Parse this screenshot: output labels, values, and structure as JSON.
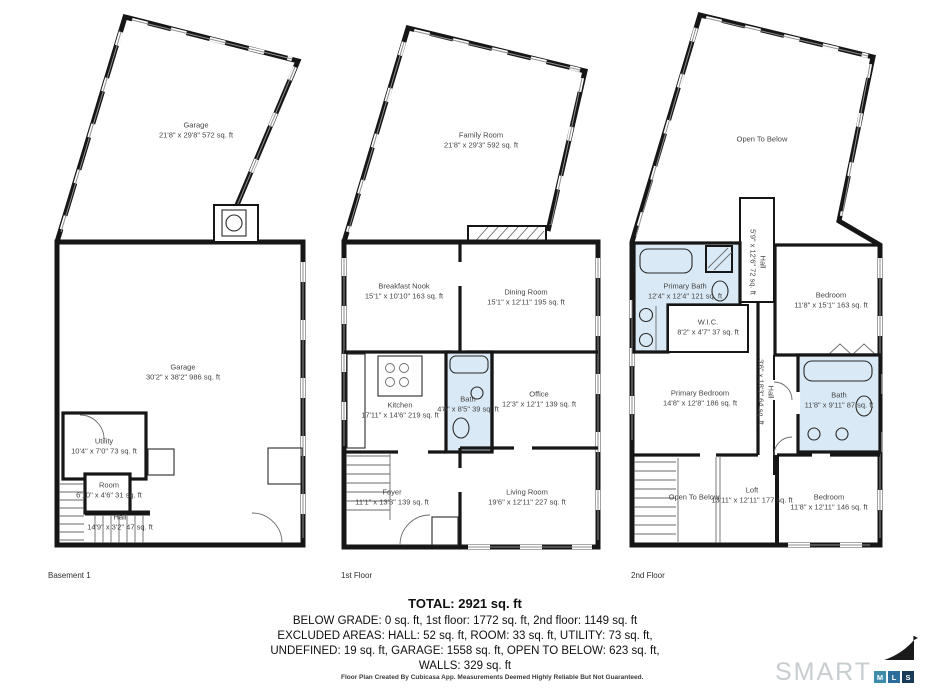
{
  "floors": [
    {
      "caption": "Basement 1",
      "rooms": [
        {
          "name": "Garage",
          "dims": "21'8\" x 29'8\" 572 sq. ft"
        },
        {
          "name": "Garage",
          "dims": "30'2\" x 38'2\" 986 sq. ft"
        },
        {
          "name": "Utility",
          "dims": "10'4\" x 7'0\" 73 sq. ft"
        },
        {
          "name": "Room",
          "dims": "6'10\" x 4'6\" 31 sq. ft"
        },
        {
          "name": "Hall",
          "dims": "14'9\" x 3'2\" 47 sq. ft"
        }
      ]
    },
    {
      "caption": "1st Floor",
      "rooms": [
        {
          "name": "Family Room",
          "dims": "21'8\" x 29'3\" 592 sq. ft"
        },
        {
          "name": "Breakfast Nook",
          "dims": "15'1\" x 10'10\" 163 sq. ft"
        },
        {
          "name": "Dining Room",
          "dims": "15'1\" x 12'11\" 195 sq. ft"
        },
        {
          "name": "Kitchen",
          "dims": "17'11\" x 14'6\" 219 sq. ft"
        },
        {
          "name": "Bath",
          "dims": "4'8\" x 8'5\" 39 sq. ft"
        },
        {
          "name": "Office",
          "dims": "12'3\" x 12'1\" 139 sq. ft"
        },
        {
          "name": "Foyer",
          "dims": "11'1\" x 13'3\" 139 sq. ft"
        },
        {
          "name": "Living Room",
          "dims": "19'6\" x 12'11\" 227 sq. ft"
        }
      ]
    },
    {
      "caption": "2nd Floor",
      "rooms": [
        {
          "name": "Open To Below",
          "dims": ""
        },
        {
          "name": "Hall",
          "dims": "5'9\" x 12'6\" 72 sq. ft"
        },
        {
          "name": "Primary Bath",
          "dims": "12'4\" x 12'4\" 121 sq. ft"
        },
        {
          "name": "W.I.C.",
          "dims": "8'2\" x 4'7\" 37 sq. ft"
        },
        {
          "name": "Bedroom",
          "dims": "11'8\" x 15'1\" 163 sq. ft"
        },
        {
          "name": "Primary Bedroom",
          "dims": "14'8\" x 12'8\" 186 sq. ft"
        },
        {
          "name": "Hall",
          "dims": "3'6\" x 18'3\" 64 sq. ft"
        },
        {
          "name": "Bath",
          "dims": "11'8\" x 9'11\" 87 sq. ft"
        },
        {
          "name": "Open To Below",
          "dims": ""
        },
        {
          "name": "Loft",
          "dims": "13'11\" x 12'11\" 177 sq. ft"
        },
        {
          "name": "Bedroom",
          "dims": "11'8\" x 12'11\" 146 sq. ft"
        }
      ]
    }
  ],
  "summary": {
    "total": "TOTAL: 2921 sq. ft",
    "line1": "BELOW GRADE: 0 sq. ft, 1st floor: 1772 sq. ft, 2nd floor: 1149 sq. ft",
    "line2": "EXCLUDED AREAS: HALL: 52 sq. ft, ROOM: 33 sq. ft, UTILITY: 73 sq. ft,",
    "line3": "UNDEFINED: 19 sq. ft, GARAGE: 1558 sq. ft, OPEN TO BELOW: 623 sq. ft,",
    "line4": "WALLS: 329 sq. ft"
  },
  "footer": {
    "disclaimer": "Floor Plan Created By Cubicasa App. Measurements Deemed Highly Reliable But Not Guaranteed."
  },
  "logo": {
    "word": "SMART",
    "boxes": [
      "M",
      "L",
      "S"
    ]
  },
  "colors": {
    "wall": "#161616",
    "bath_fill": "#d9e9f5",
    "label_text": "#454545",
    "summary_text": "#101010",
    "logo_gray": "#c8cdd0",
    "logo_box_1": "#3e8cab",
    "logo_box_2": "#2d6d9b",
    "logo_box_3": "#173a5a"
  }
}
